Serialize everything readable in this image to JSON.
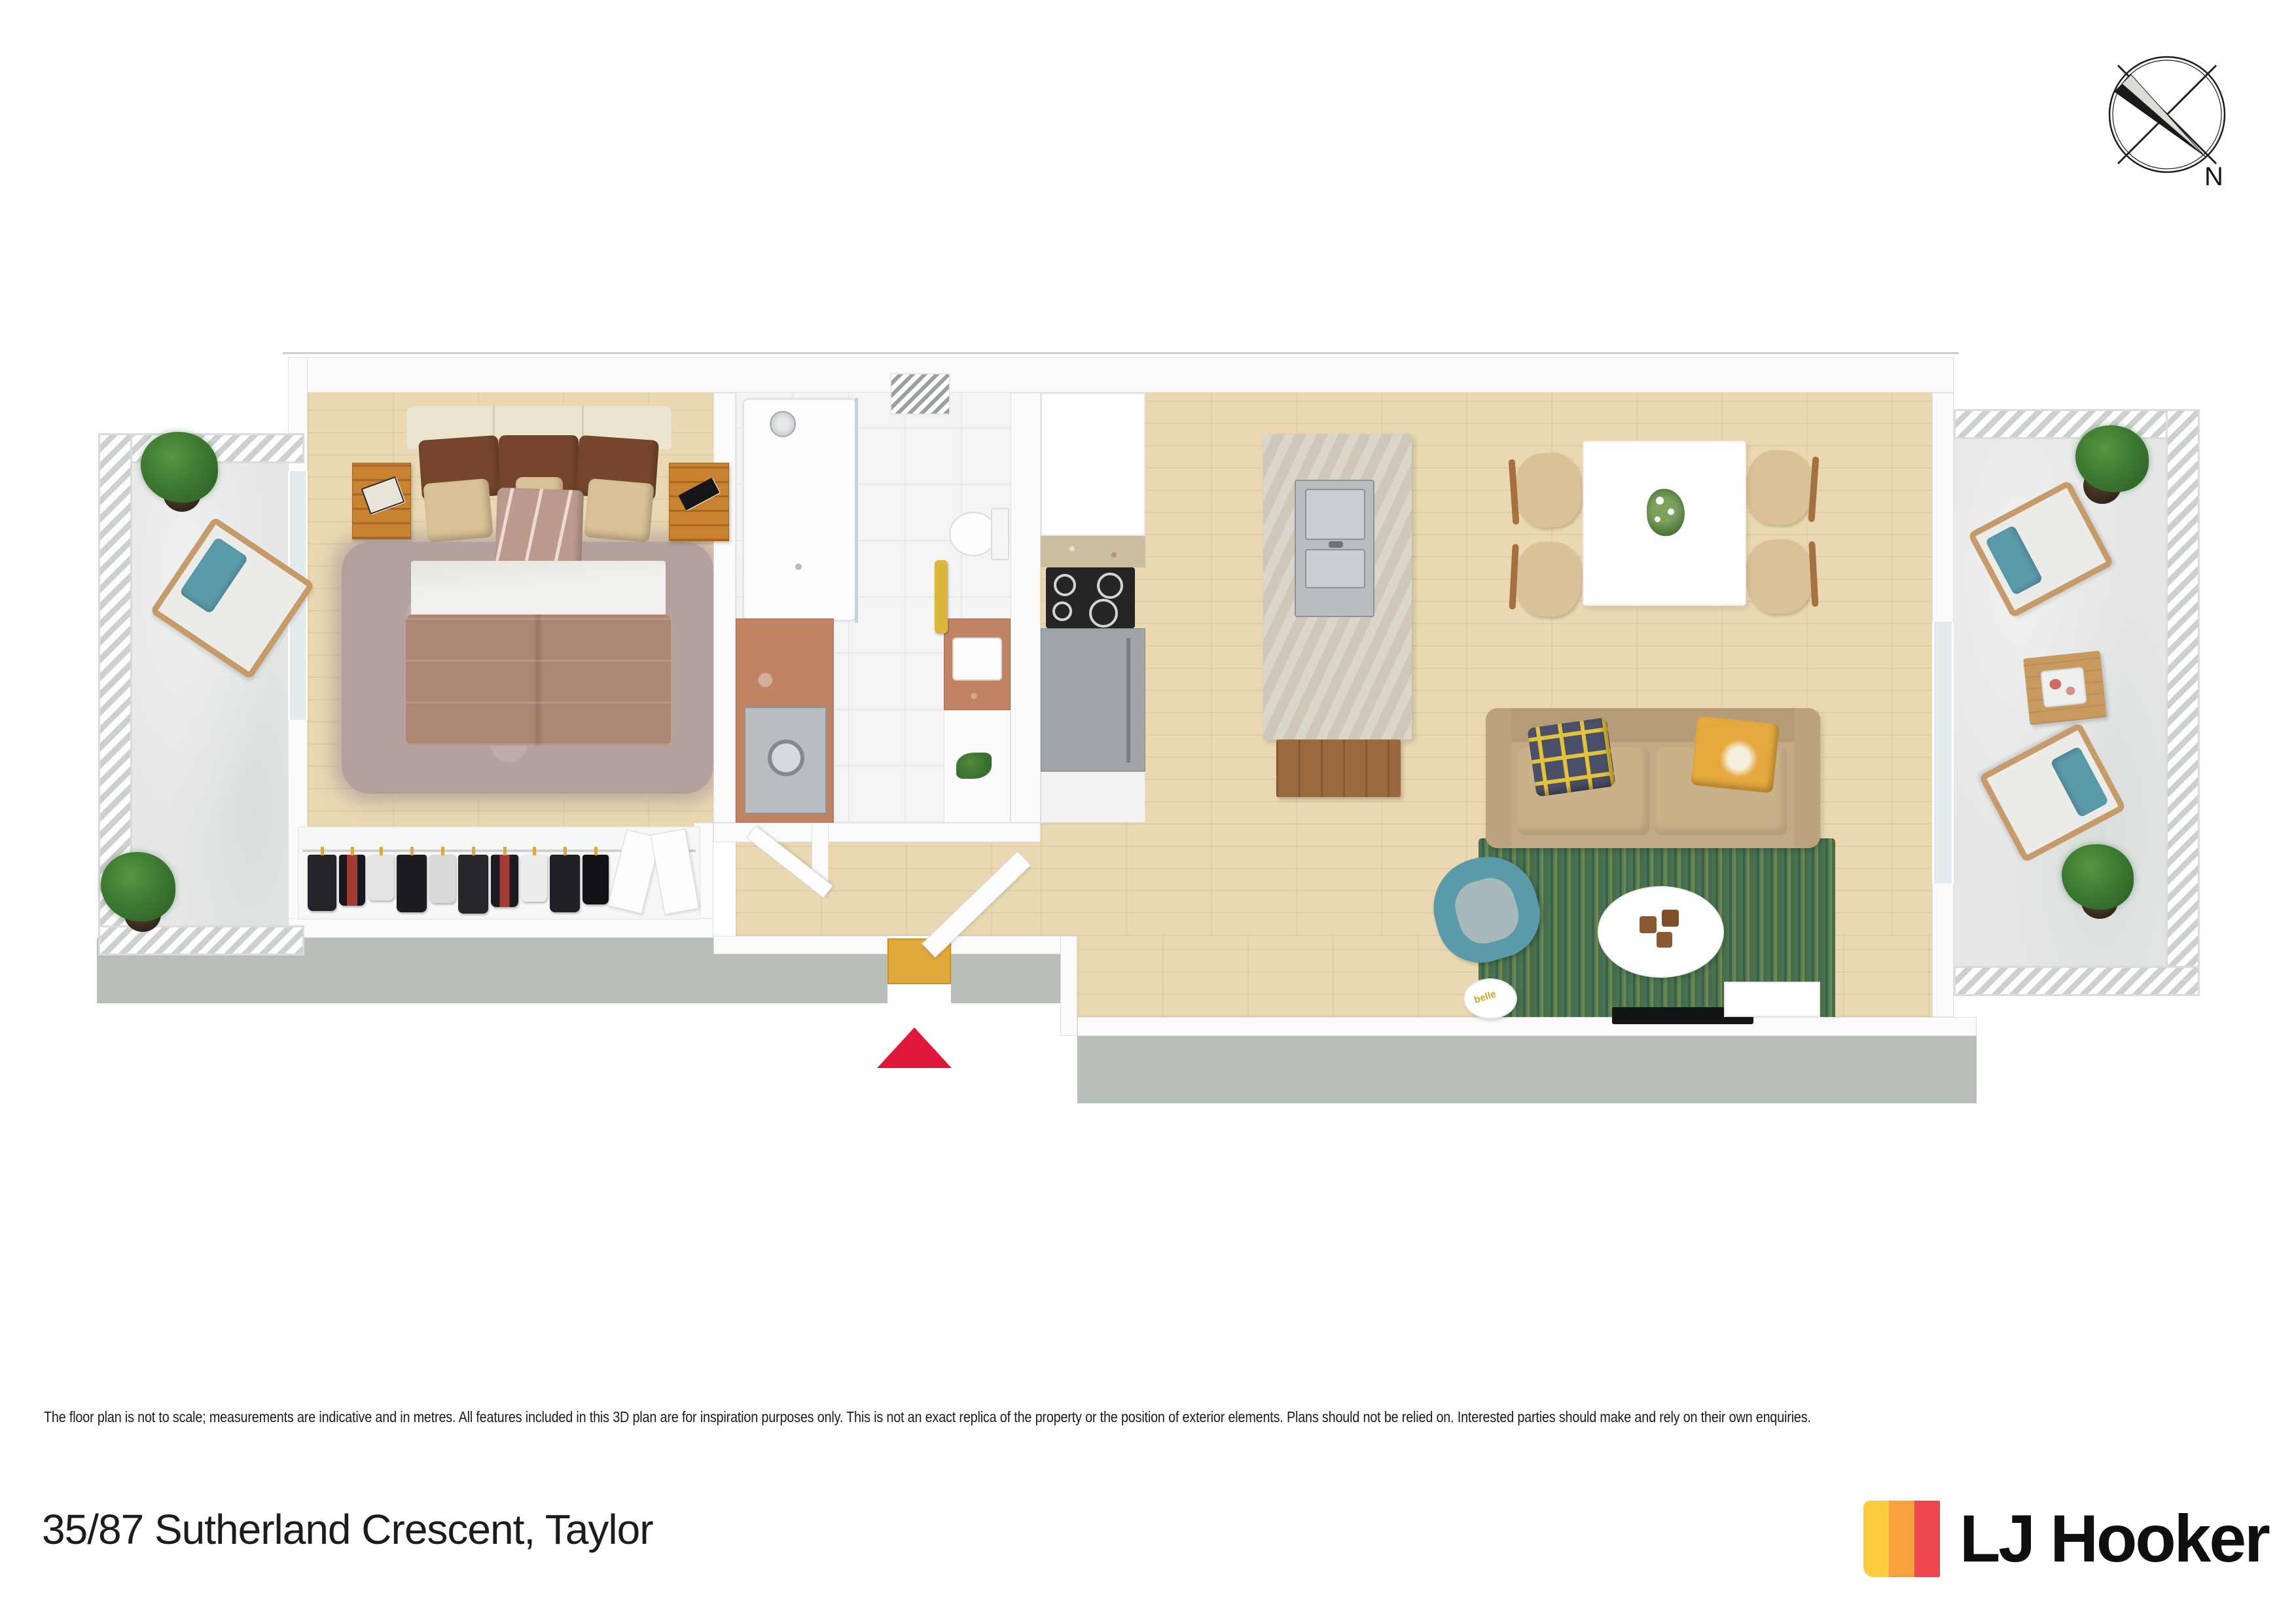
{
  "colors": {
    "accent_red": "#E0173C",
    "brand_yellow": "#FDCB40",
    "brand_orange": "#F8A13E",
    "brand_red": "#EF4650",
    "wall_white": "#FBFBFB",
    "wall_line": "#E0E0E0",
    "wall_face_grey": "#B7BEB8",
    "wood_floor": "#EAD8B2",
    "tile_floor": "#F3F4F6",
    "concrete_floor": "#E5E7E6",
    "rug_green": "#49714F",
    "rug_mauve": "#B4A19E",
    "sofa_tan": "#C2AA84",
    "teal": "#5B9AA9",
    "duvet_mauve": "#AE8774",
    "pillow_brown": "#75462D",
    "pillow_tan": "#D9C198",
    "pillow_navy": "#4B5069",
    "pillow_yellow": "#E6A93E",
    "terracotta": "#C08465",
    "island_stone": "#CFC8BA",
    "cabinet_grey": "#9FA5A8",
    "wood_furniture": "#C9822F",
    "outdoor_wicker": "#C79A6A",
    "doormat_yellow": "#DFA93C",
    "stainless": "#B9BDBF"
  },
  "compass": {
    "north_label": "N"
  },
  "living_room": {
    "magazine_label": "belle"
  },
  "footer": {
    "disclaimer": "The floor plan is not to scale; measurements are indicative and in metres. All features included in this 3D plan are for inspiration purposes only. This is not an exact replica of the property or the position of exterior elements. Plans should not be relied on. Interested parties should make and rely on their own enquiries.",
    "address": "35/87 Sutherland Crescent, Taylor",
    "brand": "LJ Hooker"
  }
}
